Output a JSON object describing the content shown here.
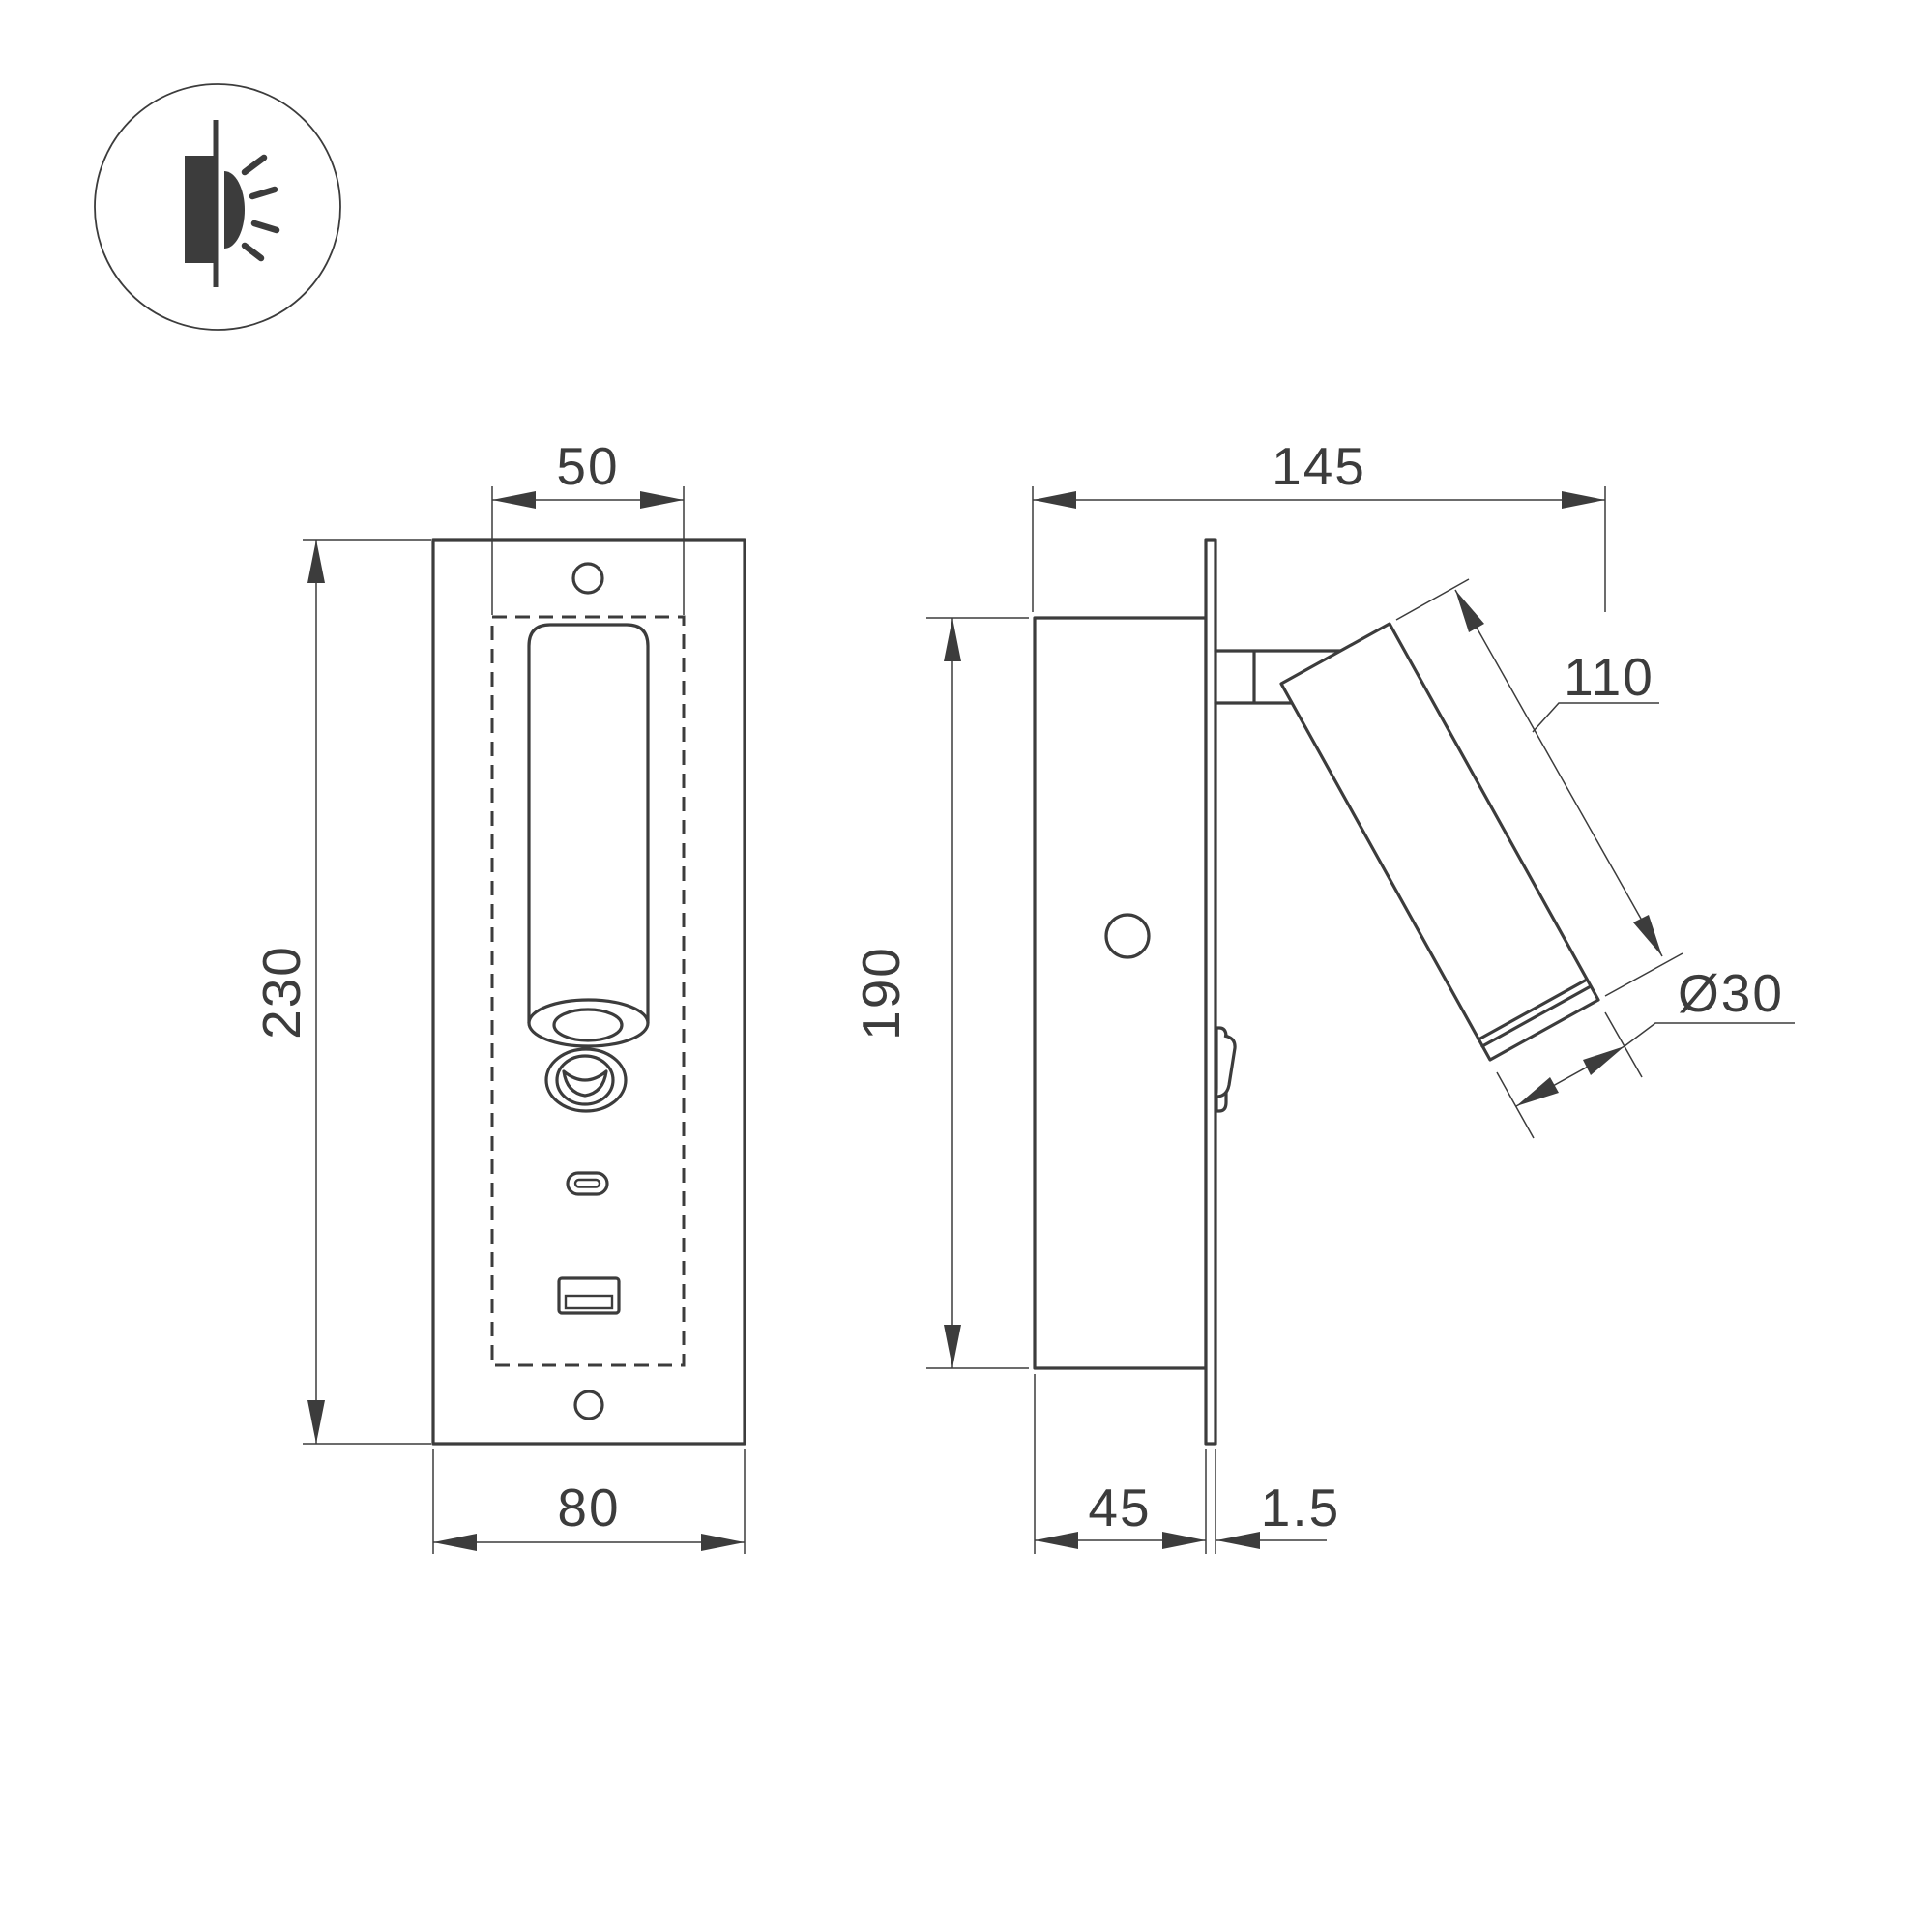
{
  "drawing": {
    "title": "recessed-bedside-reading-light-dimensional-drawing",
    "units": "mm",
    "background_color": "#ffffff",
    "line_color": "#3c3c3c",
    "icon": {
      "label": "recessed-wall-light-symbol"
    },
    "front_view": {
      "dim_top_width": "50",
      "dim_height": "230",
      "dim_bottom_width": "80"
    },
    "side_view": {
      "dim_total_depth": "145",
      "dim_body_height": "190",
      "dim_lamp_length": "110",
      "dim_lamp_diameter": "Ø30",
      "dim_recess_depth": "45",
      "dim_plate_thickness": "1.5"
    }
  }
}
